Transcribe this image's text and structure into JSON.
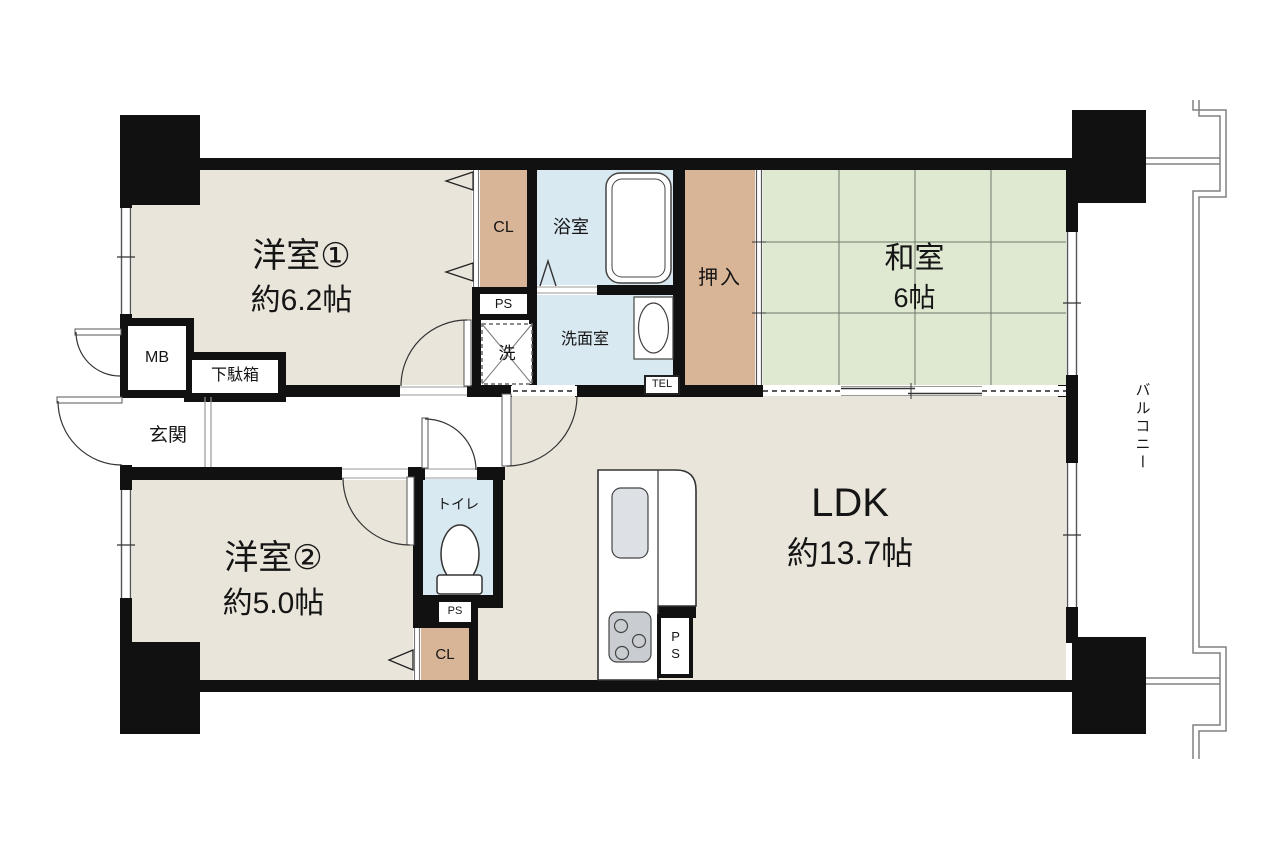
{
  "rooms": {
    "yoshitsu1": {
      "name": "洋室①",
      "size": "約6.2帖"
    },
    "yoshitsu2": {
      "name": "洋室②",
      "size": "約5.0帖"
    },
    "washitsu": {
      "name": "和室",
      "size": "6帖"
    },
    "ldk": {
      "name": "LDK",
      "size": "約13.7帖"
    },
    "bath": {
      "name": "浴室"
    },
    "senmenshitsu": {
      "name": "洗面室"
    },
    "toilet": {
      "name": "トイレ"
    },
    "genkan": {
      "name": "玄関"
    },
    "oshiire": {
      "name": "押入"
    },
    "balcony": {
      "name": "バルコニー"
    }
  },
  "fixtures": {
    "mb": "MB",
    "getabako": "下駄箱",
    "tel": "TEL",
    "washer": "洗",
    "cl_upper": "CL",
    "cl_lower": "CL",
    "ps_upper": "PS",
    "ps_toilet": "PS",
    "ps_kitchen": "PS"
  },
  "colors": {
    "wall": "#111111",
    "room": "#EAE5DB",
    "tatami": "#DFE9D2",
    "tatami_line": "#6F7A6A",
    "closet": "#D8B596",
    "water": "#D9E9F2",
    "appliance": "#C9CDD2",
    "sink": "#DDE0E4",
    "line": "#333333",
    "thin": "#777777",
    "rail": "#808080"
  }
}
